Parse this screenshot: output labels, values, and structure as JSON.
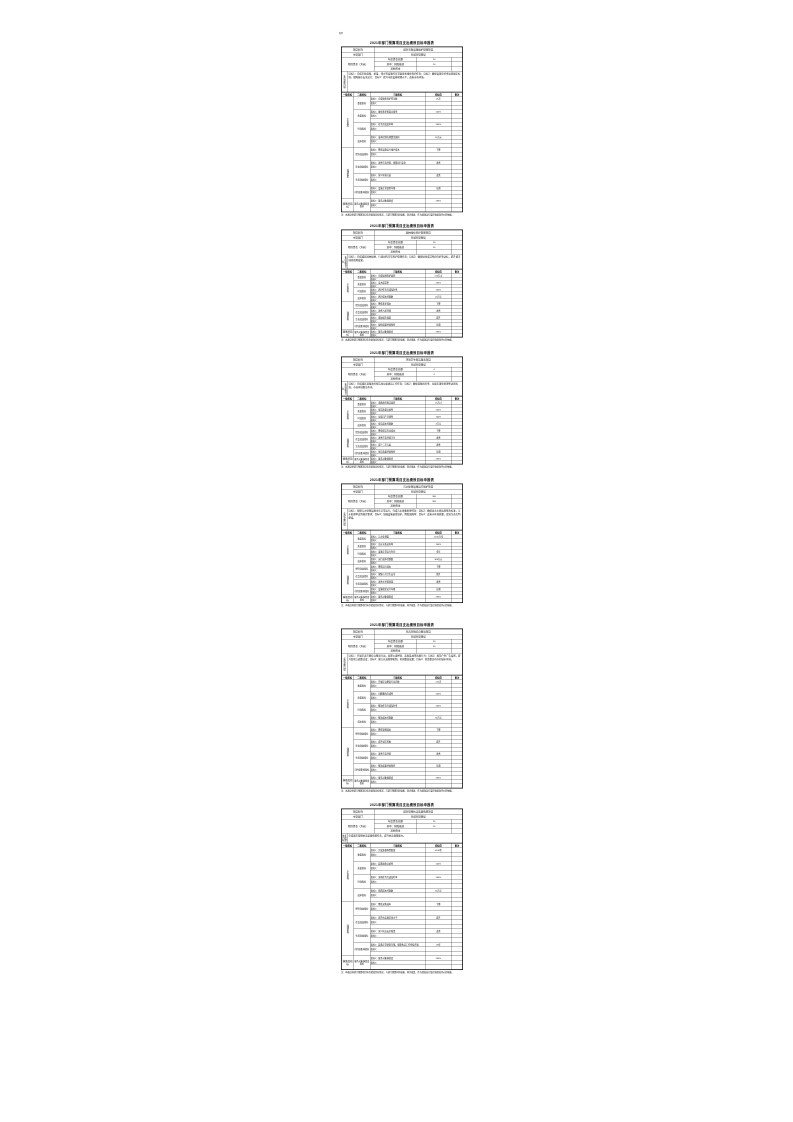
{
  "page": {
    "corner_mark": "附5"
  },
  "common": {
    "title": "2021年部门预算项目支出绩效目标申报表",
    "labels": {
      "project": "项目名称",
      "dept": "主管部门",
      "fund": "项目资金（万元）",
      "fund_total": "年度资金总额",
      "fund_finance": "其中：财政拨款",
      "fund_other": "其他资金",
      "goal": "年度总体目标",
      "headers": [
        "一级指标",
        "二级指标",
        "三级指标",
        "指标值",
        "备注"
      ],
      "level1": [
        "产出指标",
        "效益指标",
        "满意度指标"
      ],
      "groups": [
        "数量指标",
        "质量指标",
        "时效指标",
        "成本指标",
        "经济效益指标",
        "社会效益指标",
        "生态效益指标",
        "可持续影响指标",
        "服务对象满意度指标"
      ],
      "indicator2": "指标2：",
      "footnote": "注：本表反映部门预算项目年度绩效目标情况，与部门预算同步编报、同步批复，作为绩效运行监控和绩效评价的依据。"
    }
  },
  "tables": [
    {
      "project_name": "城市市政设施维护管理项目",
      "dept_name": "市城市管理局",
      "fund_total": "50",
      "fund_finance": "50",
      "fund_other": "",
      "goal": "目标1：完成市政道路、桥梁、排水等设施的日常巡查和维修养护任务；目标2：确保设施完好率达到规定标准，保障城市安全运行；目标3：提升市政设施管理水平，改善市容环境。",
      "indicators": [
        {
          "text": "指标1：完成维修养护任务数",
          "value": "≥1次"
        },
        {
          "text": "指标1：维修养护质量合格率",
          "value": "100%"
        },
        {
          "text": "指标1：任务完成及时率",
          "value": "100%"
        },
        {
          "text": "指标1：成本控制在预算范围内",
          "value": "50万元"
        },
        {
          "text": "指标1：降低设施运行维护成本",
          "value": "下降"
        },
        {
          "text": "指标1：改善市容环境、保障出行安全",
          "value": "改善"
        },
        {
          "text": "指标1：减少环境污染",
          "value": "改善"
        },
        {
          "text": "指标1：设施正常使用年限",
          "value": "长期"
        },
        {
          "text": "指标1：服务对象满意度",
          "value": "≥95%"
        }
      ]
    },
    {
      "project_name": "园林绿化养护管理项目",
      "dept_name": "市城市管理局",
      "fund_total": "20",
      "fund_finance": "20",
      "fund_other": "",
      "goal": "目标1：完成城区园林绿地、行道树的日常养护管理任务；目标2：确保绿化成活率和完好率达标，提升城市绿化景观效果。",
      "indicators": [
        {
          "text": "指标1：完成绿地养护面积",
          "value": "≥10万㎡"
        },
        {
          "text": "指标1：苗木成活率",
          "value": "≥95%"
        },
        {
          "text": "指标1：养护任务完成及时率",
          "value": "100%"
        },
        {
          "text": "指标1：养护成本控制数",
          "value": "20万元"
        },
        {
          "text": "指标1：降低养护成本",
          "value": "下降"
        },
        {
          "text": "指标1：改善人居环境",
          "value": "改善"
        },
        {
          "text": "指标1：增加城市绿量",
          "value": "提升"
        },
        {
          "text": "指标1：绿化成果持续保持",
          "value": "长期"
        },
        {
          "text": "指标1：服务对象满意度",
          "value": "≥95%"
        }
      ]
    },
    {
      "project_name": "环境卫生保洁服务项目",
      "dept_name": "市城市管理局",
      "fund_total": "4",
      "fund_finance": "4",
      "fund_other": "",
      "goal": "目标1：完成城区道路清扫保洁和垃圾清运工作任务；目标2：确保道路机扫率、垃圾无害化处理率达到标准，市容环境整洁有序。",
      "indicators": [
        {
          "text": "指标1：道路清扫保洁面积",
          "value": "≥5万㎡"
        },
        {
          "text": "指标1：保洁质量合格率",
          "value": "100%"
        },
        {
          "text": "指标1：垃圾日产日清率",
          "value": "100%"
        },
        {
          "text": "指标1：保洁成本控制数",
          "value": "4万元"
        },
        {
          "text": "指标1：降低保洁作业成本",
          "value": "下降"
        },
        {
          "text": "指标1：改善市容环境卫生",
          "value": "改善"
        },
        {
          "text": "指标1：减少二次污染",
          "value": "改善"
        },
        {
          "text": "指标1：保洁效果持续保持",
          "value": "长期"
        },
        {
          "text": "指标1：服务对象满意度",
          "value": "≥95%"
        }
      ]
    },
    {
      "project_name": "污水处理设施运行维护项目",
      "dept_name": "市城市管理局",
      "fund_total": "300",
      "fund_finance": "300",
      "fund_other": "",
      "goal": "目标1：保障污水处理设施全年正常运行，完成污水收集处理任务；目标2：确保出水水质达到排放标准，污水处理率达到规定要求；目标3：加强设施巡查维护，降低故障率；目标4：改善水环境质量，促进生态文明建设。",
      "indicators": [
        {
          "text": "指标1：污水处理量",
          "value": "≥100万吨"
        },
        {
          "text": "指标1：出水水质达标率",
          "value": "100%"
        },
        {
          "text": "指标1：设施正常运行时间",
          "value": "全年"
        },
        {
          "text": "指标1：运行成本控制数",
          "value": "300万元"
        },
        {
          "text": "指标1：降低运行成本",
          "value": "下降"
        },
        {
          "text": "指标1：保障公共卫生安全",
          "value": "提升"
        },
        {
          "text": "指标1：改善水环境质量",
          "value": "改善"
        },
        {
          "text": "指标1：设施稳定运行年限",
          "value": "长期"
        },
        {
          "text": "指标1：服务对象满意度",
          "value": "≥95%"
        }
      ]
    },
    {
      "project_name": "市容市貌综合整治项目",
      "dept_name": "市城市管理局",
      "fund_total": "30",
      "fund_finance": "30",
      "fund_other": "",
      "goal": "目标1：开展市容市貌综合整治行动，治理占道经营、乱贴乱画等违规行为；目标2：规范户外广告设置，提升街景立面整洁度；目标3：建立长效管理机制，巩固整治成果；目标4：营造整洁有序的城市环境。",
      "indicators": [
        {
          "text": "指标1：开展综合整治行动次数",
          "value": "≥12次"
        },
        {
          "text": "指标1：问题整改完成率",
          "value": "100%"
        },
        {
          "text": "指标1：整治任务完成及时率",
          "value": "100%"
        },
        {
          "text": "指标1：整治成本控制数",
          "value": "30万元"
        },
        {
          "text": "指标1：降低管理成本",
          "value": "下降"
        },
        {
          "text": "指标1：提升城市形象",
          "value": "提升"
        },
        {
          "text": "指标1：改善市容环境",
          "value": "改善"
        },
        {
          "text": "指标1：整治成果持续保持",
          "value": "长期"
        },
        {
          "text": "指标1：服务对象满意度",
          "value": "≥95%"
        }
      ]
    },
    {
      "project_name": "城市管理执法装备购置项目",
      "dept_name": "市城市管理局",
      "fund_total": "50",
      "fund_finance": "50",
      "fund_other": "",
      "goal": "完成城市管理执法装备购置任务，提升执法保障能力。",
      "indicators": [
        {
          "text": "指标1：完成装备购置数量",
          "value": "≥100件"
        },
        {
          "text": "指标1：装备验收合格率",
          "value": "100%"
        },
        {
          "text": "指标1：采购任务完成及时率",
          "value": "100%"
        },
        {
          "text": "指标1：购置成本控制数",
          "value": "50万元"
        },
        {
          "text": "指标1：降低采购成本",
          "value": "下降"
        },
        {
          "text": "指标1：提升执法规范化水平",
          "value": "提升"
        },
        {
          "text": "指标1：减少执法安全隐患",
          "value": "改善"
        },
        {
          "text": "指标1：装备正常使用年限，保障执法工作持续开展",
          "value": "≥8年"
        },
        {
          "text": "指标1：服务对象满意度",
          "value": "100%"
        }
      ]
    }
  ],
  "layout_note": ""
}
